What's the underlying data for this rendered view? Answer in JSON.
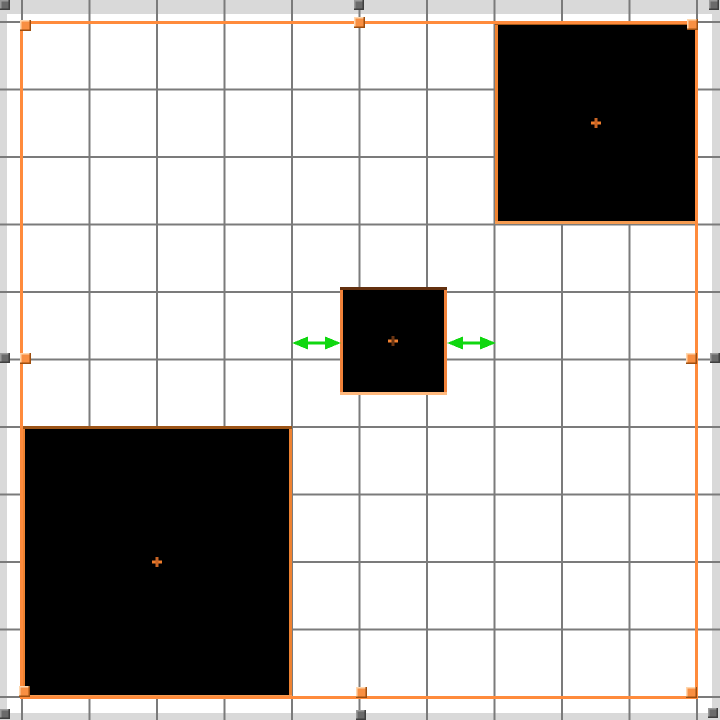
{
  "scene": {
    "width": 720,
    "height": 720,
    "background": "#ffffff",
    "frame": {
      "strip_color": "#d9d9d9",
      "strips": [
        {
          "name": "top",
          "x": 0,
          "y": 0,
          "w": 720,
          "h": 14
        },
        {
          "name": "left",
          "x": 0,
          "y": 0,
          "w": 7,
          "h": 720
        },
        {
          "name": "right",
          "x": 712,
          "y": 0,
          "w": 8,
          "h": 720
        },
        {
          "name": "bottom",
          "x": 0,
          "y": 713,
          "w": 720,
          "h": 7
        }
      ],
      "handle": {
        "size": 10,
        "fill": "#6a6a6a",
        "light": "#9a9a9a",
        "dark": "#3f3f3f"
      },
      "handle_positions": [
        {
          "pos": "top-left",
          "x": 0,
          "y": 0
        },
        {
          "pos": "top-middle",
          "x": 354,
          "y": 0
        },
        {
          "pos": "top-right",
          "x": 709,
          "y": 0
        },
        {
          "pos": "middle-left",
          "x": 0,
          "y": 353
        },
        {
          "pos": "middle-right",
          "x": 710,
          "y": 353
        },
        {
          "pos": "bottom-left",
          "x": 0,
          "y": 709
        },
        {
          "pos": "bottom-middle",
          "x": 356,
          "y": 710
        },
        {
          "pos": "bottom-right",
          "x": 708,
          "y": 708
        }
      ]
    },
    "grid": {
      "color": "#7b7b7b",
      "line_width": 2,
      "start": 22,
      "spacing": 67.5,
      "count": 11
    },
    "squares": [
      {
        "name": "bottom-left",
        "x": 22,
        "y": 426,
        "w": 270,
        "h": 272,
        "fill": "#000000",
        "border": {
          "width": 3,
          "top": "#9c5417",
          "side": "#ee8231",
          "bottom": "#f59c52"
        },
        "cross": {
          "cx": 157,
          "cy": 562,
          "h_color": "#ef7d2c",
          "v_color": "#c86425"
        }
      },
      {
        "name": "top-right",
        "x": 495,
        "y": 22,
        "w": 203,
        "h": 202,
        "fill": "#000000",
        "border": {
          "width": 3,
          "top": "#a85a1a",
          "side": "#ee8231",
          "bottom": "#f59c52"
        },
        "cross": {
          "cx": 596,
          "cy": 123,
          "h_color": "#ef7d2c",
          "v_color": "#c86425"
        }
      },
      {
        "name": "middle",
        "x": 340,
        "y": 287,
        "w": 107,
        "h": 108,
        "fill": "#000000",
        "border": {
          "width": 3,
          "top": "#63300f",
          "side": "#f0823a",
          "bottom": "#ffb97e"
        },
        "cross": {
          "cx": 393,
          "cy": 341,
          "h_color": "#f08030",
          "v_color": "#6b3512"
        }
      }
    ],
    "selection": {
      "x": 21.5,
      "y": 22.5,
      "w": 675,
      "h": 675,
      "stroke": "#ff8b3c",
      "stroke_width": 3,
      "handle": {
        "size": 11,
        "fill": "#f88f42",
        "light": "#ffd7ae",
        "dark": "#9e4e0e"
      },
      "handle_positions": [
        {
          "pos": "top-left",
          "x": 20,
          "y": 20
        },
        {
          "pos": "top-middle",
          "x": 354,
          "y": 17
        },
        {
          "pos": "top-right",
          "x": 687,
          "y": 19
        },
        {
          "pos": "middle-left",
          "x": 20,
          "y": 353
        },
        {
          "pos": "middle-right",
          "x": 686,
          "y": 353
        },
        {
          "pos": "bottom-left",
          "x": 19,
          "y": 686
        },
        {
          "pos": "bottom-middle",
          "x": 356,
          "y": 687
        },
        {
          "pos": "bottom-right",
          "x": 686,
          "y": 687
        }
      ]
    },
    "arrows": {
      "color": "#10d710",
      "y": 343,
      "shaft_width": 3,
      "head_length": 16,
      "head_width": 13,
      "items": [
        {
          "side": "left",
          "x1": 292,
          "x2": 341
        },
        {
          "side": "right",
          "x1": 447,
          "x2": 496
        }
      ]
    }
  }
}
